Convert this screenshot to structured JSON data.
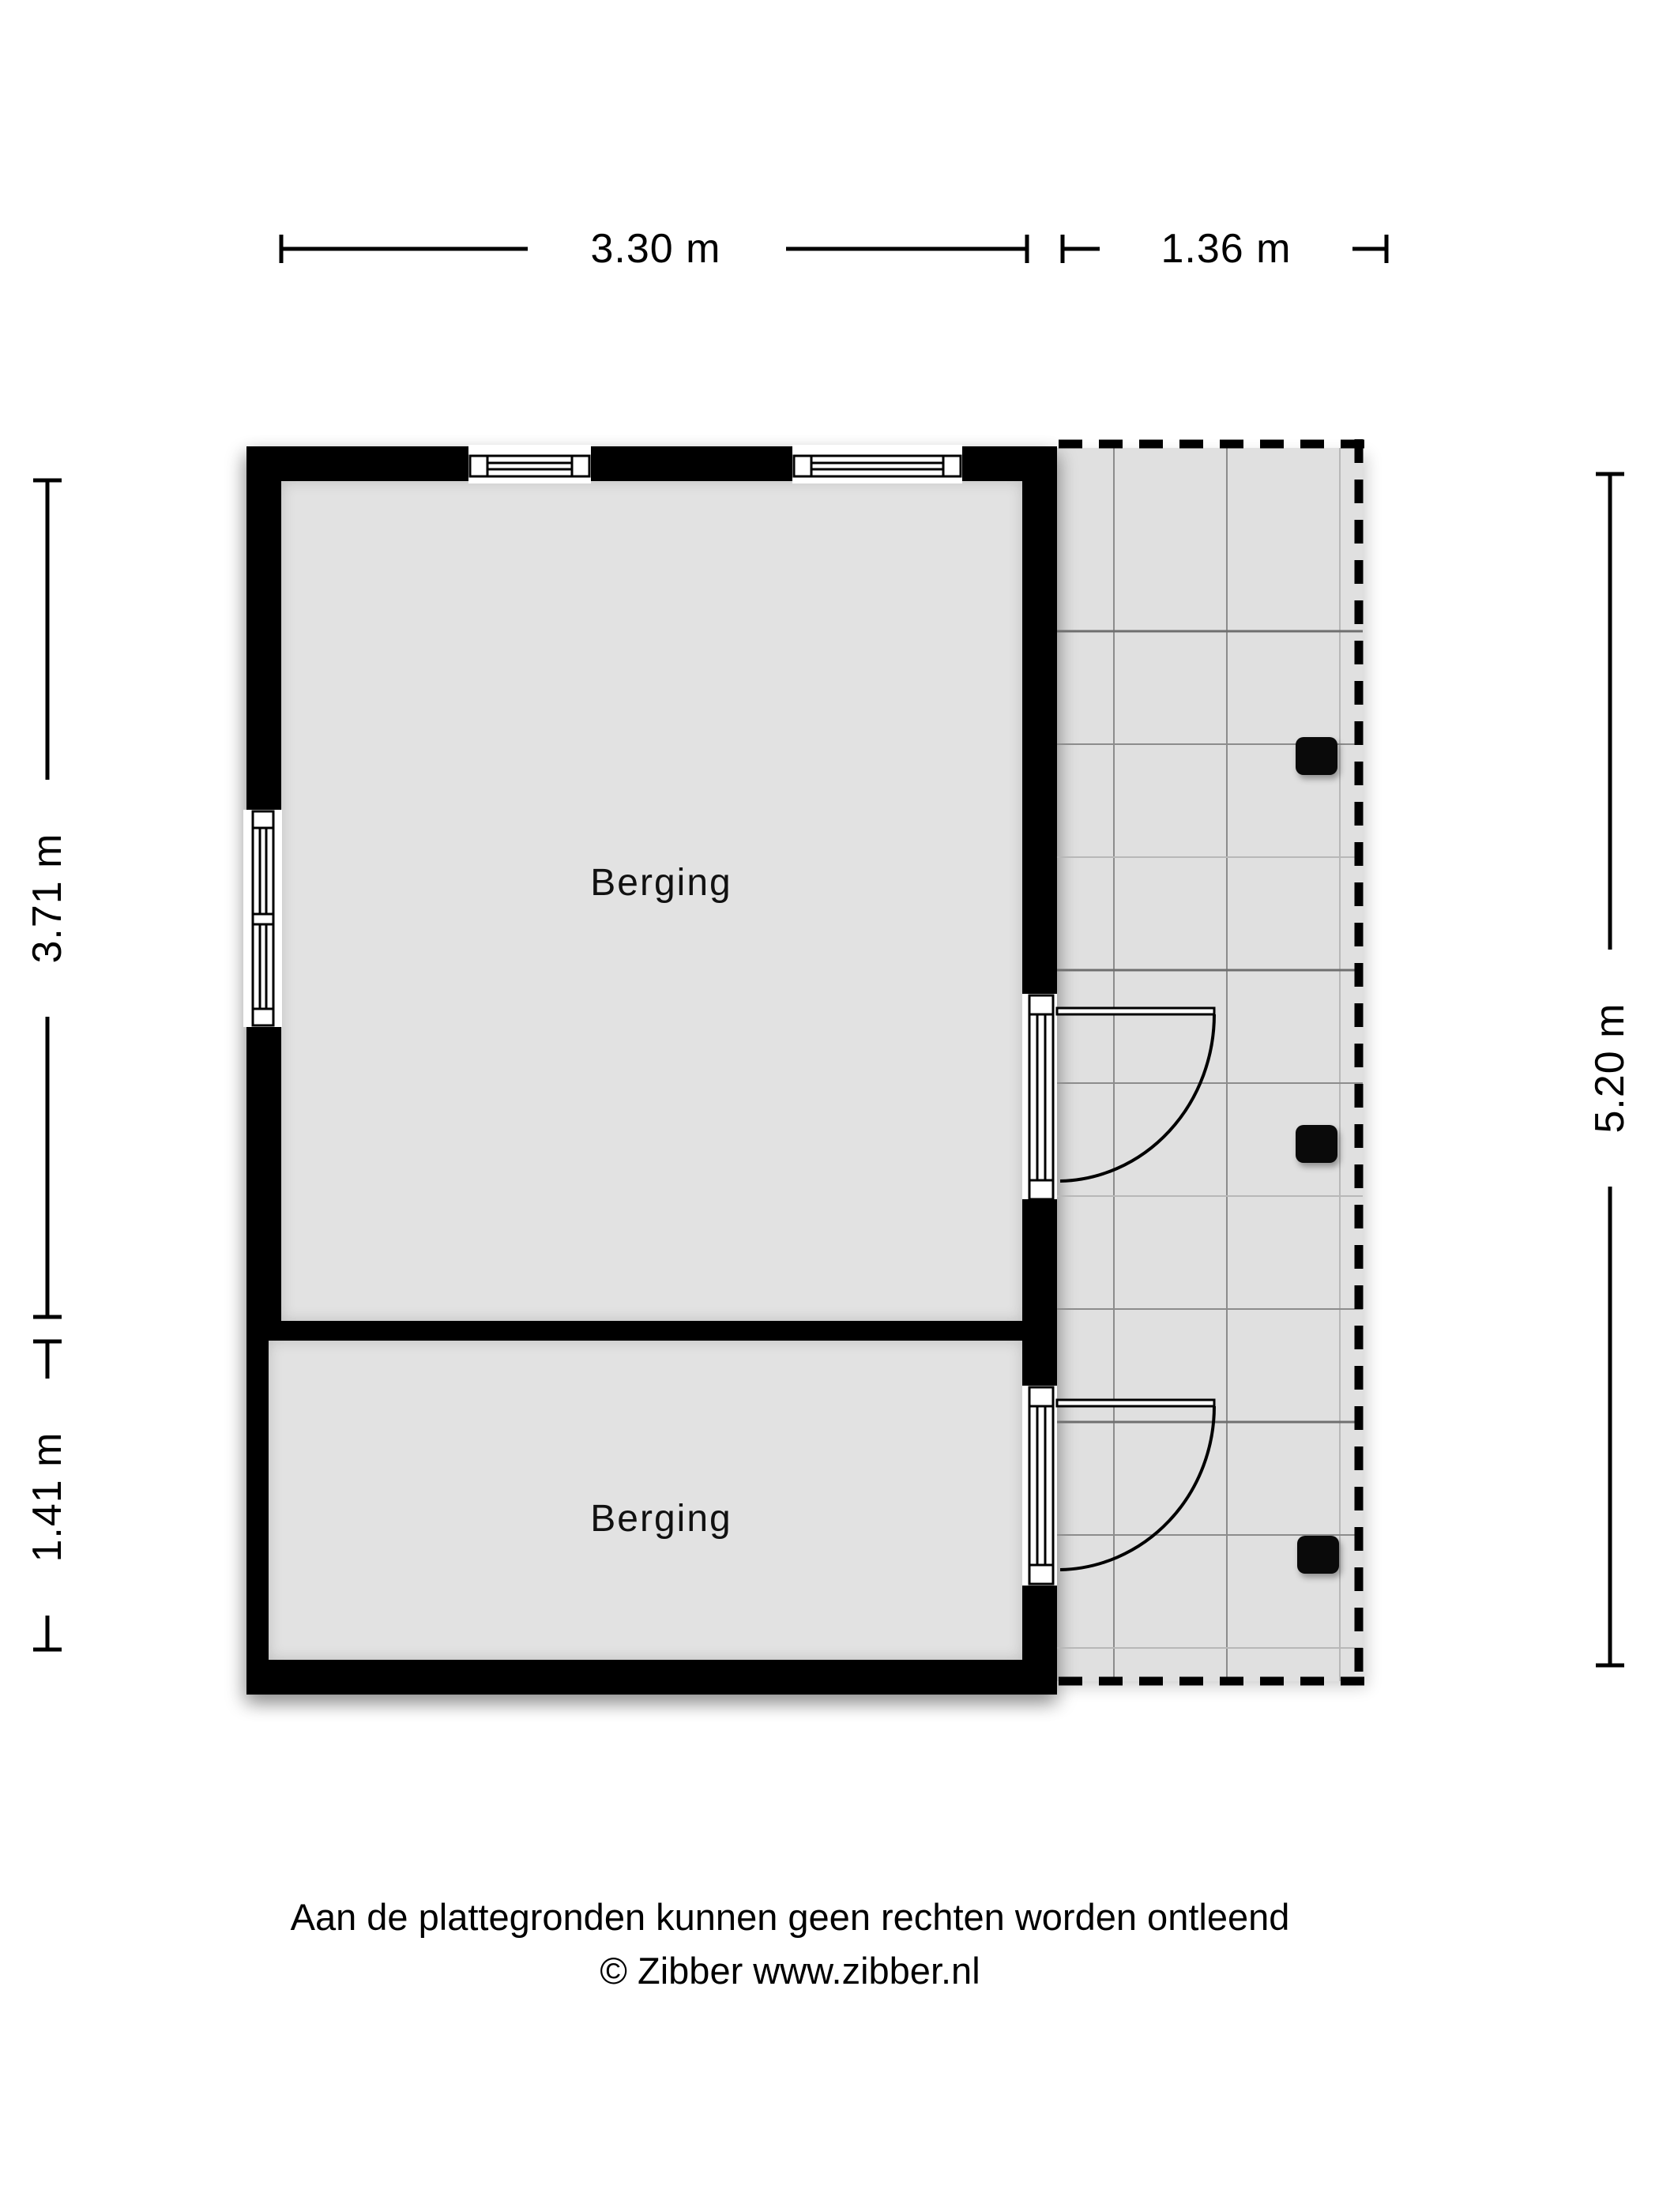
{
  "floorplan": {
    "rooms": [
      {
        "name": "Berging"
      },
      {
        "name": "Berging"
      }
    ],
    "dimensions": {
      "top_main": "3.30 m",
      "top_patio": "1.36 m",
      "left_upper": "3.71 m",
      "left_lower": "1.41 m",
      "right_total": "5.20 m"
    },
    "patio": {
      "posts": 3
    },
    "colors": {
      "wall": "#000000",
      "room_floor": "#e2e2e2",
      "patio_floor": "#e0e0e0",
      "grid_line": "#8c8c8c",
      "text": "#000000"
    }
  },
  "footer": {
    "disclaimer": "Aan de plattegronden kunnen geen rechten worden ontleend",
    "credit": "© Zibber www.zibber.nl"
  }
}
